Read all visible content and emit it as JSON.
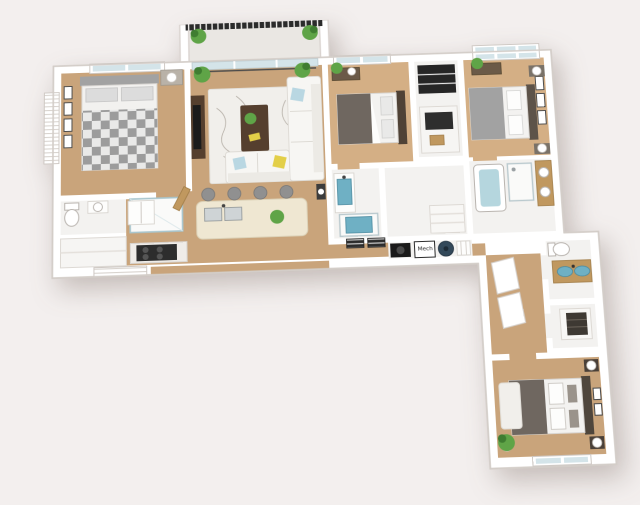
{
  "scene": {
    "type": "3d-floorplan-render",
    "view": "isometric-top-down",
    "shape": "L-shaped unit, horizontal wing on top and vertical wing at lower right"
  },
  "labels": {
    "mech": "Mech"
  },
  "palette": {
    "bg": "#f3efee",
    "wall": "#ffffff",
    "wall_edge": "#d9d3cf",
    "wood": "#c9a47b",
    "wood_light": "#d4af85",
    "tile": "#f3f2f0",
    "balcony": "#eae7e3",
    "glass": "#d4e4e9",
    "railing": "#2b2b2b",
    "plant": "#5fa447",
    "plant_dark": "#3f7d31",
    "sofa": "#f7f6f3",
    "cushion_blue": "#b9d7e2",
    "cushion_yellow": "#e3cf48",
    "rug": "#f1efeb",
    "rug_pattern": "#b7b1a9",
    "bed_gray": "#a2a2a2",
    "bed_dark": "#6f6760",
    "wood_dark": "#553f2e",
    "tv_black": "#1b1b1b",
    "island": "#efe7d2",
    "steel": "#cfd4d6",
    "sink_blue": "#6fb0c4",
    "tub_blue": "#b5d6de",
    "heater": "#33495a",
    "door_wood": "#c0985f"
  },
  "rooms": [
    {
      "id": "balcony",
      "floor": "concrete",
      "features": [
        "metal railing",
        "2 potted plants"
      ]
    },
    {
      "id": "living-room",
      "floor": "wood",
      "features": [
        "L-shaped white sectional sofa",
        "blue and yellow accent pillows",
        "patterned area rug",
        "dark wood coffee table with plant and book",
        "tv console with tv",
        "2 potted plants",
        "sliding glass balcony door"
      ]
    },
    {
      "id": "kitchen",
      "floor": "wood",
      "features": [
        "island with double sink",
        "4 bar stools",
        "range with black grates",
        "refrigerator",
        "breakfast ledge",
        "window with blinds"
      ]
    },
    {
      "id": "bedroom-left",
      "floor": "wood",
      "features": [
        "queen bed with gray checkered blanket",
        "nightstand with lamp",
        "4 wall frames",
        "top window",
        "side window with shutters"
      ]
    },
    {
      "id": "bathroom-left",
      "floor": "tile",
      "features": [
        "toilet",
        "sink",
        "glass shower",
        "wood door",
        "closet"
      ]
    },
    {
      "id": "bedroom-middle",
      "floor": "wood",
      "features": [
        "bed with gray blanket",
        "dark headboard",
        "dresser with plant",
        "window"
      ]
    },
    {
      "id": "bathroom-middle",
      "floor": "tile",
      "features": [
        "blue sink vanity",
        "blue-floor shower",
        "wall vents"
      ]
    },
    {
      "id": "closet-hall",
      "floor": "tile",
      "features": [
        "dark shelving units",
        "linen shelves"
      ]
    },
    {
      "id": "bedroom-right",
      "floor": "wood",
      "features": [
        "bed with gray blanket",
        "2 nightstands with lamps",
        "wall frames",
        "dresser with plant",
        "large window"
      ]
    },
    {
      "id": "bathroom-right",
      "floor": "tile",
      "features": [
        "bathtub",
        "shower stall",
        "wood vanity with 2 basins"
      ]
    },
    {
      "id": "utility-row",
      "floor": "tile",
      "features": [
        "black washer-dryer front",
        "mech closet",
        "round water heater",
        "striped cabinet"
      ]
    },
    {
      "id": "hallway-leg",
      "floor": "wood",
      "features": [
        "angled closet doors"
      ]
    },
    {
      "id": "bathroom-leg",
      "floor": "tile",
      "features": [
        "toilet",
        "double vanity with 2 blue oval sinks"
      ]
    },
    {
      "id": "walk-in-closet",
      "floor": "tile",
      "features": [
        "dark drawer unit",
        "shelving"
      ]
    },
    {
      "id": "bedroom-bottom",
      "floor": "wood",
      "features": [
        "bed with dark blanket and patterned pillows",
        "2 nightstands with round lamps",
        "wall frames",
        "white rug",
        "corner plant",
        "bottom window"
      ]
    }
  ]
}
